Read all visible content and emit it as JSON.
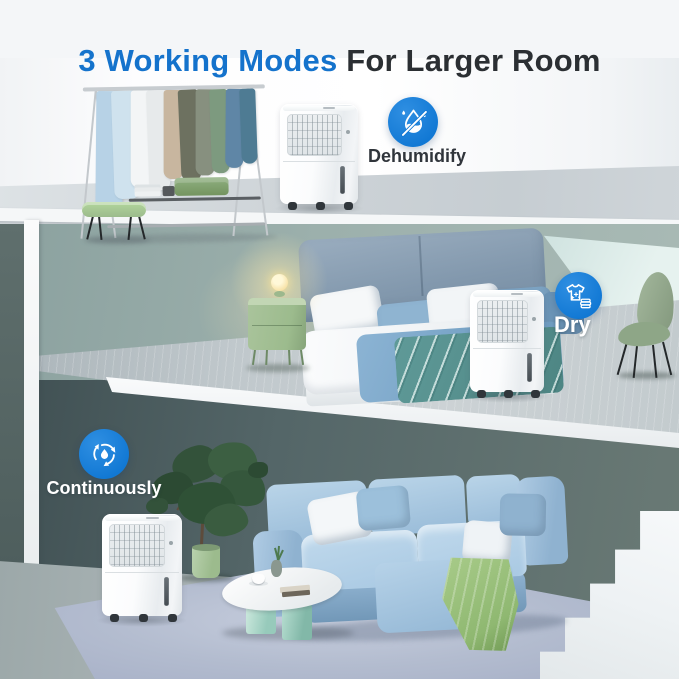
{
  "title": {
    "highlight": "3 Working Modes",
    "rest": " For Larger Room"
  },
  "modes": [
    {
      "name": "dehumidify",
      "label": "Dehumidify",
      "icon": "dehumidify-drop-slash-icon"
    },
    {
      "name": "dry",
      "label": "Dry",
      "icon": "dry-clean-shirt-icon"
    },
    {
      "name": "continuously",
      "label": "Continuously",
      "icon": "continuous-cycle-drop-icon"
    }
  ],
  "colors": {
    "title_highlight": "#1573cc",
    "title_text": "#2b2f33",
    "badge_blue": "#1178d4",
    "label_dark": "#30353b",
    "label_light": "#ffffff",
    "wall_sage": "#9cb0ac",
    "wall_mint": "#e6f2ef",
    "wall_dark": "#546668",
    "rug_blue": "#b3bccf",
    "sofa_blue": "#a9c9e3",
    "throw_green": "#8fb871",
    "furniture_green": "#9cbb8d",
    "dehumidifier_white": "#f7f9fa"
  }
}
